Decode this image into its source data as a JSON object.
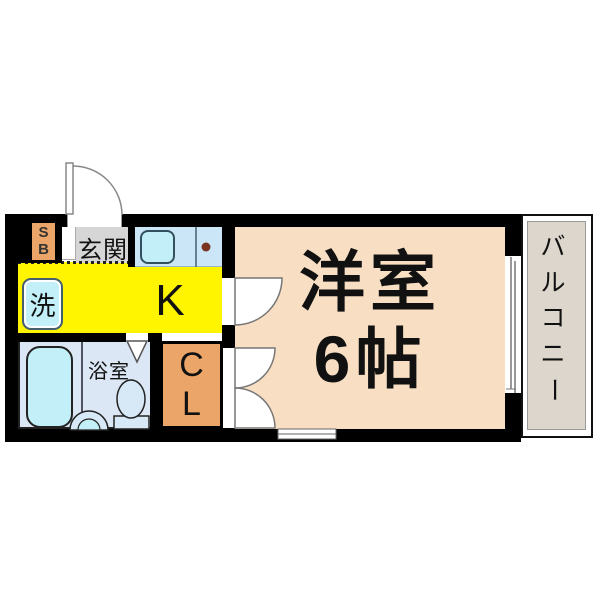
{
  "plan": {
    "entrance": {
      "label": "玄関"
    },
    "shoe_box": {
      "chars": [
        "S",
        "B"
      ]
    },
    "kitchen": {
      "label": "K"
    },
    "laundry": {
      "label": "洗"
    },
    "bathroom": {
      "label": "浴室"
    },
    "closet": {
      "chars": [
        "C",
        "L"
      ]
    },
    "western_room": {
      "name": "洋室",
      "size": "6帖"
    },
    "balcony": {
      "label": "バルコニー",
      "chars": [
        "バ",
        "ル",
        "コ",
        "ニ",
        "ー"
      ]
    }
  },
  "colors": {
    "wall": "#000000",
    "kitchen_yellow": "#FFF500",
    "room_peach": "#F8DFC3",
    "accent_orange": "#ECA568",
    "fixture_cyan": "#C2EFF8",
    "counter_blue": "#CBE7F7",
    "bath_floor_blue": "#DBE7F4",
    "genkan_gray": "#D6D6D6",
    "balcony_gray": "#DCD6CC",
    "stove_dot_brown": "#7A3522"
  }
}
